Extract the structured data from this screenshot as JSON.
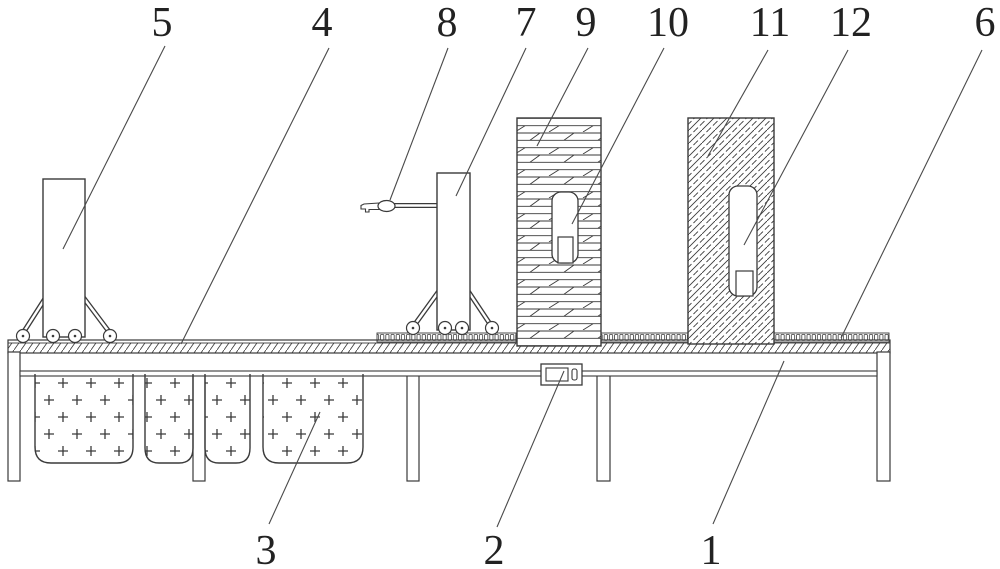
{
  "figure": {
    "background_color": "#ffffff",
    "line_color": "#3a3a3a",
    "callouts": {
      "c1": "1",
      "c2": "2",
      "c3": "3",
      "c4": "4",
      "c5": "5",
      "c6": "6",
      "c7": "7",
      "c8": "8",
      "c9": "9",
      "c10": "10",
      "c11": "11",
      "c12": "12"
    }
  }
}
